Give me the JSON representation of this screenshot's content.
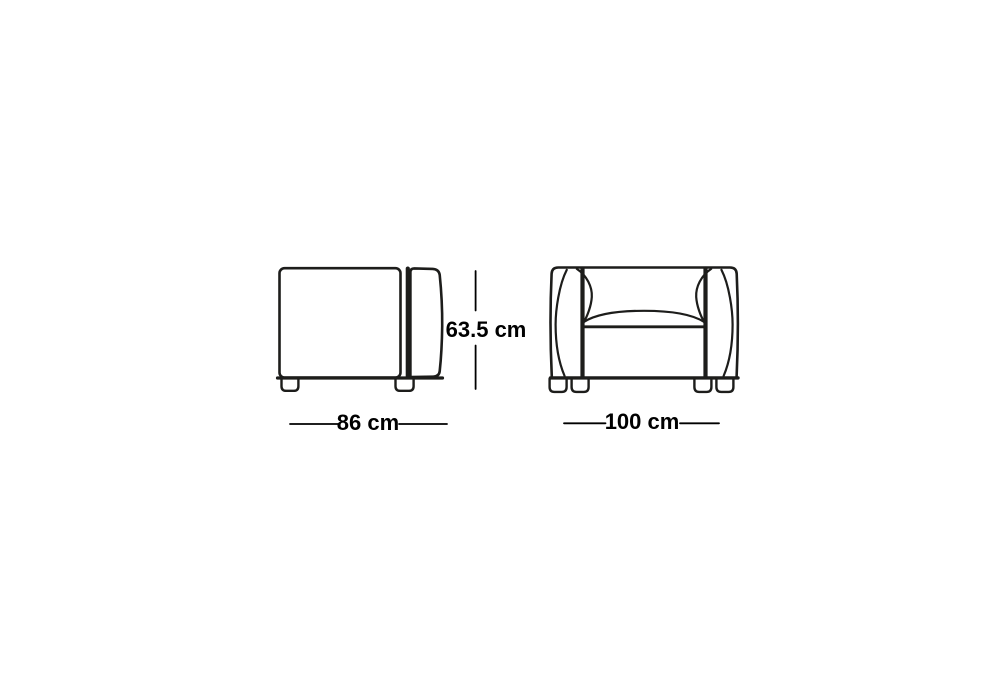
{
  "drawing": {
    "background": "#ffffff",
    "line_color": "#1d1d1b",
    "text_color": "#000000",
    "side_view": {
      "width_label": "86 cm",
      "height_label": "63.5 cm"
    },
    "front_view": {
      "width_label": "100 cm"
    }
  }
}
